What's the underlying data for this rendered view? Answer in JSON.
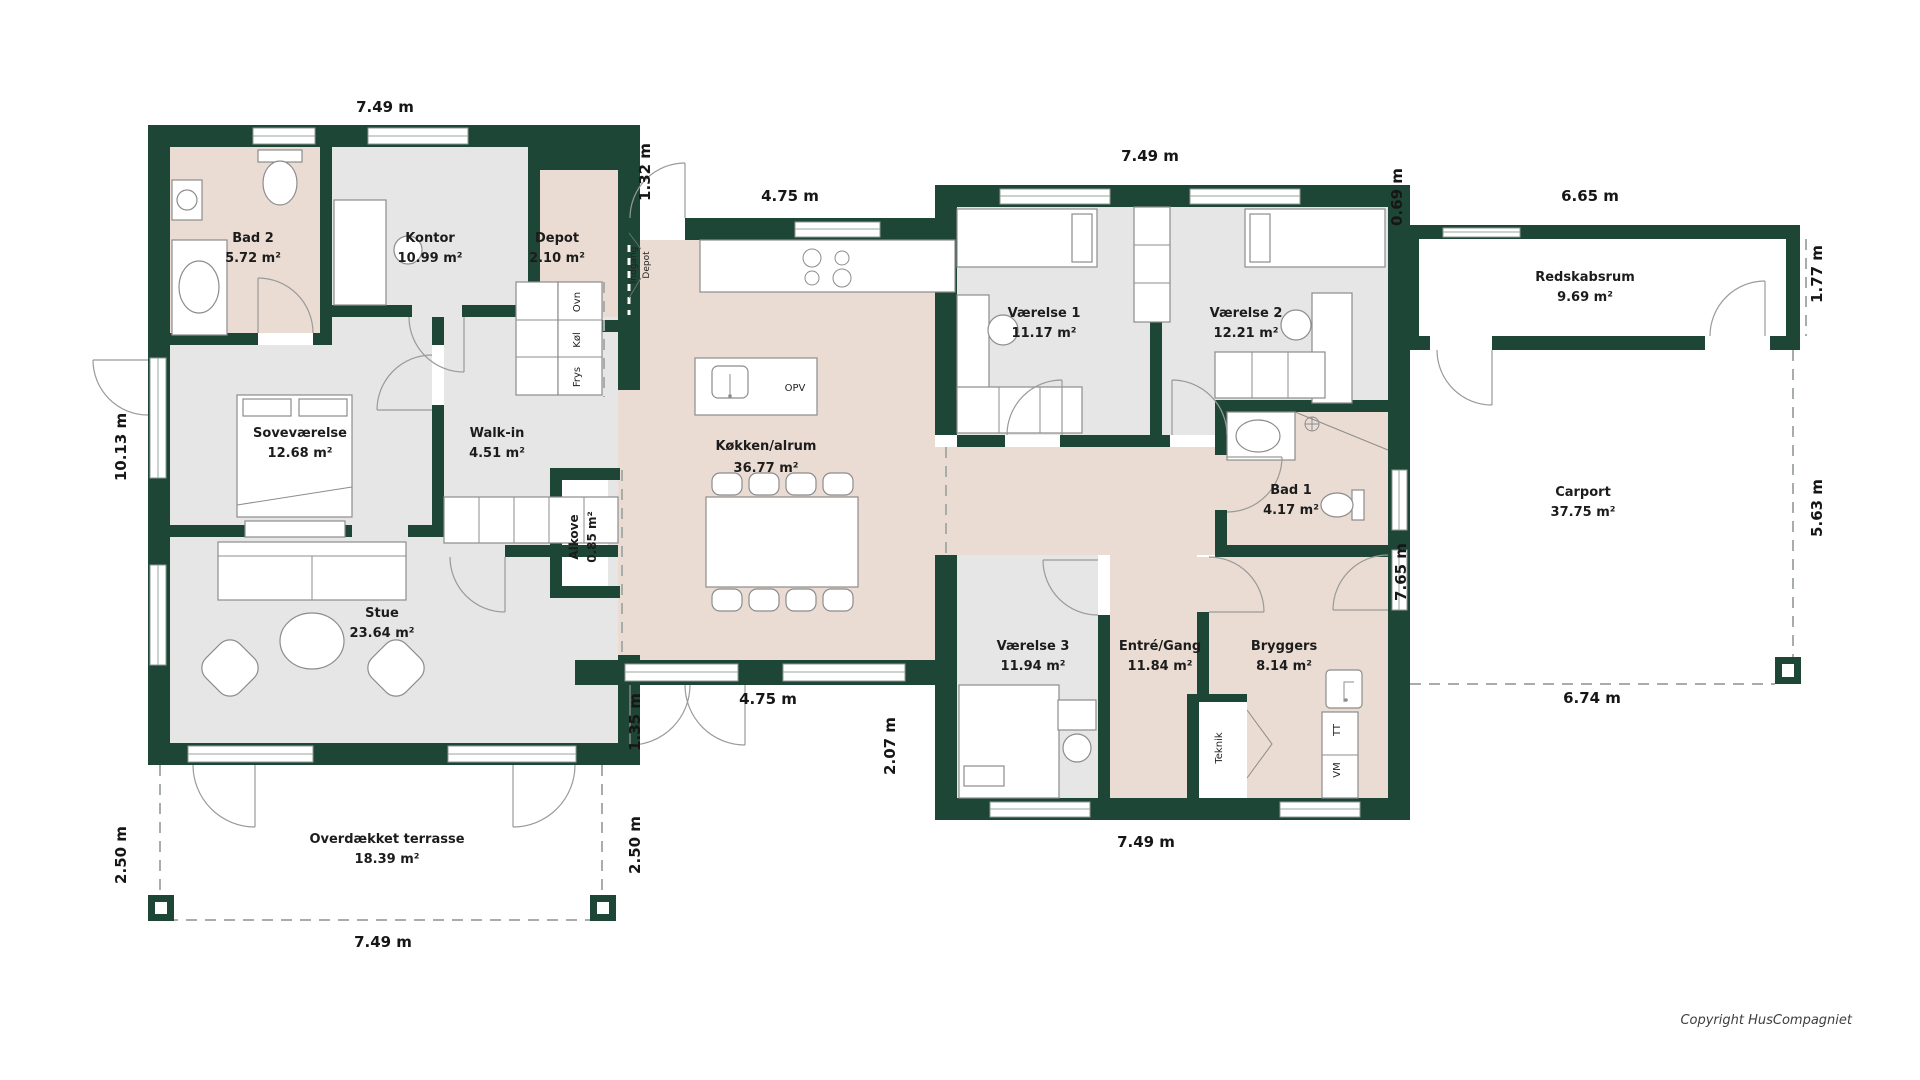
{
  "colors": {
    "wall_green": "#1d4637",
    "floor_grey": "#e5e6e5",
    "floor_beige": "#eadcd3",
    "background": "#ffffff"
  },
  "rooms": {
    "bad2": {
      "name": "Bad 2",
      "area": "5.72 m²"
    },
    "kontor": {
      "name": "Kontor",
      "area": "10.99 m²"
    },
    "depot": {
      "name": "Depot",
      "area": "2.10 m²"
    },
    "sovevaerelse": {
      "name": "Soveværelse",
      "area": "12.68 m²"
    },
    "walkin": {
      "name": "Walk-in",
      "area": "4.51 m²"
    },
    "alkove": {
      "name": "Alkove",
      "area": "0.85 m²"
    },
    "stue": {
      "name": "Stue",
      "area": "23.64 m²"
    },
    "kokken": {
      "name": "Køkken/alrum",
      "area": "36.77 m²"
    },
    "vaerelse1": {
      "name": "Værelse 1",
      "area": "11.17 m²"
    },
    "vaerelse2": {
      "name": "Værelse 2",
      "area": "12.21 m²"
    },
    "bad1": {
      "name": "Bad 1",
      "area": "4.17 m²"
    },
    "vaerelse3": {
      "name": "Værelse 3",
      "area": "11.94 m²"
    },
    "entre": {
      "name": "Entré/Gang",
      "area": "11.84 m²"
    },
    "bryggers": {
      "name": "Bryggers",
      "area": "8.14 m²"
    },
    "redskabsrum": {
      "name": "Redskabsrum",
      "area": "9.69 m²"
    },
    "carport": {
      "name": "Carport",
      "area": "37.75 m²"
    },
    "terrasse": {
      "name": "Overdækket terrasse",
      "area": "18.39 m²"
    }
  },
  "dimensions": {
    "top_left": "7.49 m",
    "entry_door": "1.32 m",
    "kitchen_top": "4.75 m",
    "bedrooms_top": "7.49 m",
    "annex_offset": "0.69 m",
    "annex_top": "6.65 m",
    "annex_right": "1.77 m",
    "house_left": "10.13 m",
    "carport_right": "5.63 m",
    "house_right": "7.65 m",
    "kitchen_bottom": "4.75 m",
    "kitchen_bottom_left": "1.35 m",
    "terrace_step": "2.07 m",
    "bedrooms_bottom": "7.49 m",
    "carport_bottom": "6.74 m",
    "terrace_left": "2.50 m",
    "terrace_right": "2.50 m",
    "terrace_bottom": "7.49 m"
  },
  "fixtures": {
    "oven": "Ovn",
    "fridge": "Køl",
    "freezer": "Frys",
    "dishwasher": "OPV",
    "utility": "Teknik",
    "dryer": "TT",
    "washer": "VM",
    "entrance_line1": "Indgang",
    "entrance_line2": "Depot"
  },
  "footer": {
    "copyright": "Copyright HusCompagniet"
  }
}
